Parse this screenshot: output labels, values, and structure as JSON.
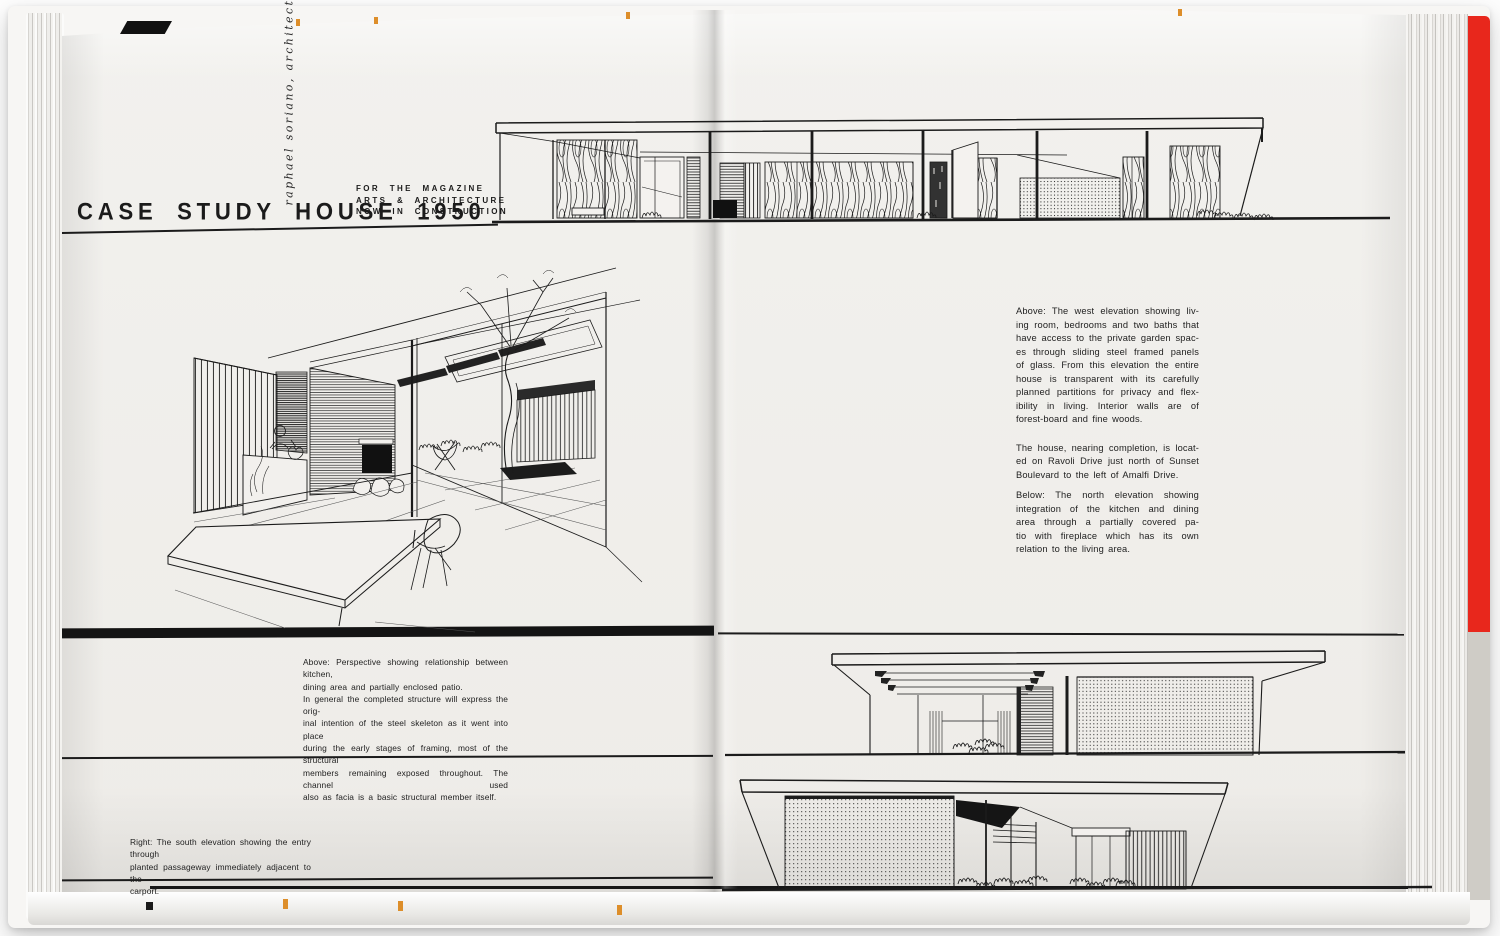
{
  "page_header": {
    "architect_vertical": "raphael soriano, architect",
    "title": "CASE STUDY HOUSE 1950",
    "subtitle_lines": [
      "FOR THE MAGAZINE",
      "ARTS & ARCHITECTURE",
      "NOW IN CONSTRUCTION"
    ]
  },
  "left_page": {
    "mid_caption": {
      "paragraphs": [
        [
          "Above:  Perspective showing relationship between kitchen,",
          "dining area and partially enclosed patio."
        ],
        [
          "In general the completed structure will express the orig-",
          "inal intention of the steel skeleton as it went into place",
          "during the early stages of framing, most of the structural",
          "members remaining exposed throughout.  The channel used",
          "also as facia is a basic structural member itself."
        ]
      ]
    },
    "bottom_caption": {
      "paragraphs": [
        [
          "Right: The south elevation showing the entry through",
          "planted passageway immediately adjacent to the",
          "carport."
        ]
      ]
    }
  },
  "right_page": {
    "text_block": {
      "paragraphs": [
        [
          "Above:  The west elevation showing liv-",
          "ing room, bedrooms and two baths that",
          "have access to the private garden spac-",
          "es through sliding steel framed panels",
          "of glass.  From this elevation the entire",
          "house is transparent with its carefully",
          "planned partitions for privacy and flex-",
          "ibility in living.  Interior walls are of",
          "forest-board and fine woods."
        ],
        [
          "The house, nearing completion, is locat-",
          "ed on Ravoli Drive just north of Sunset",
          "Boulevard to the left of Amalfi Drive."
        ],
        [
          "Below:  The north elevation showing",
          "integration of the kitchen and dining",
          "area through a partially covered pa-",
          "tio with fireplace which has its own",
          "relation to the living area."
        ]
      ]
    }
  },
  "drawings": {
    "west_elevation": "West elevation drawing",
    "kitchen_perspective": "Perspective of kitchen, dining area and patio",
    "north_elevation": "North elevation drawing",
    "south_elevation": "South elevation drawing"
  },
  "colors": {
    "page": "#f1efec",
    "ink": "#1b1b1b",
    "red_edge": "#e8271c",
    "orange_mark": "#dd8e2a",
    "cover": "#f7f6f4"
  }
}
